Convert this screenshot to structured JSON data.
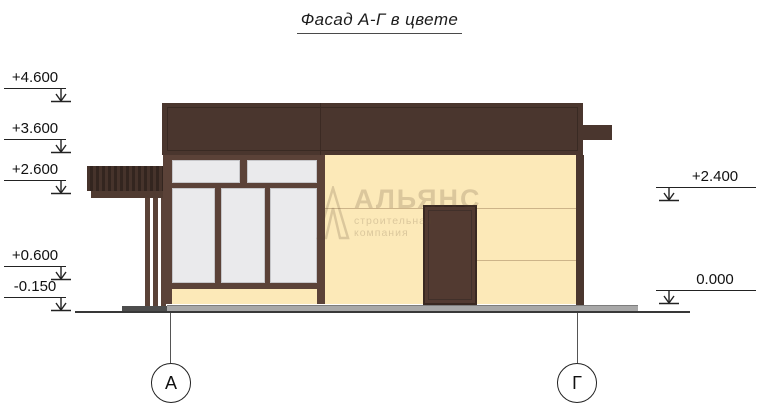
{
  "title": "Фасад А-Г в цвете",
  "elevation_marks": {
    "left": [
      {
        "label": "+4.600"
      },
      {
        "label": "+3.600"
      },
      {
        "label": "+2.600"
      },
      {
        "label": "+0.600"
      },
      {
        "label": "-0.150"
      }
    ],
    "right": [
      {
        "label": "+2.400"
      },
      {
        "label": "0.000"
      }
    ]
  },
  "axes": [
    {
      "label": "А"
    },
    {
      "label": "Г"
    }
  ],
  "watermark": {
    "brand": "АЛЬЯНС",
    "tagline": "строительная компания"
  },
  "colors": {
    "roof_brown": "#4a362e",
    "frame_brown": "#5b4238",
    "door_brown": "#523a31",
    "wall_cream": "#fce9b8",
    "glass_gray": "#eaeaec",
    "plinth_gray": "#a8a8a8",
    "pavement_dark": "#4d4d4d",
    "ground_line": "#383838",
    "wall_joint_line": "#cdb489",
    "watermark_tone": "#5a4531"
  }
}
